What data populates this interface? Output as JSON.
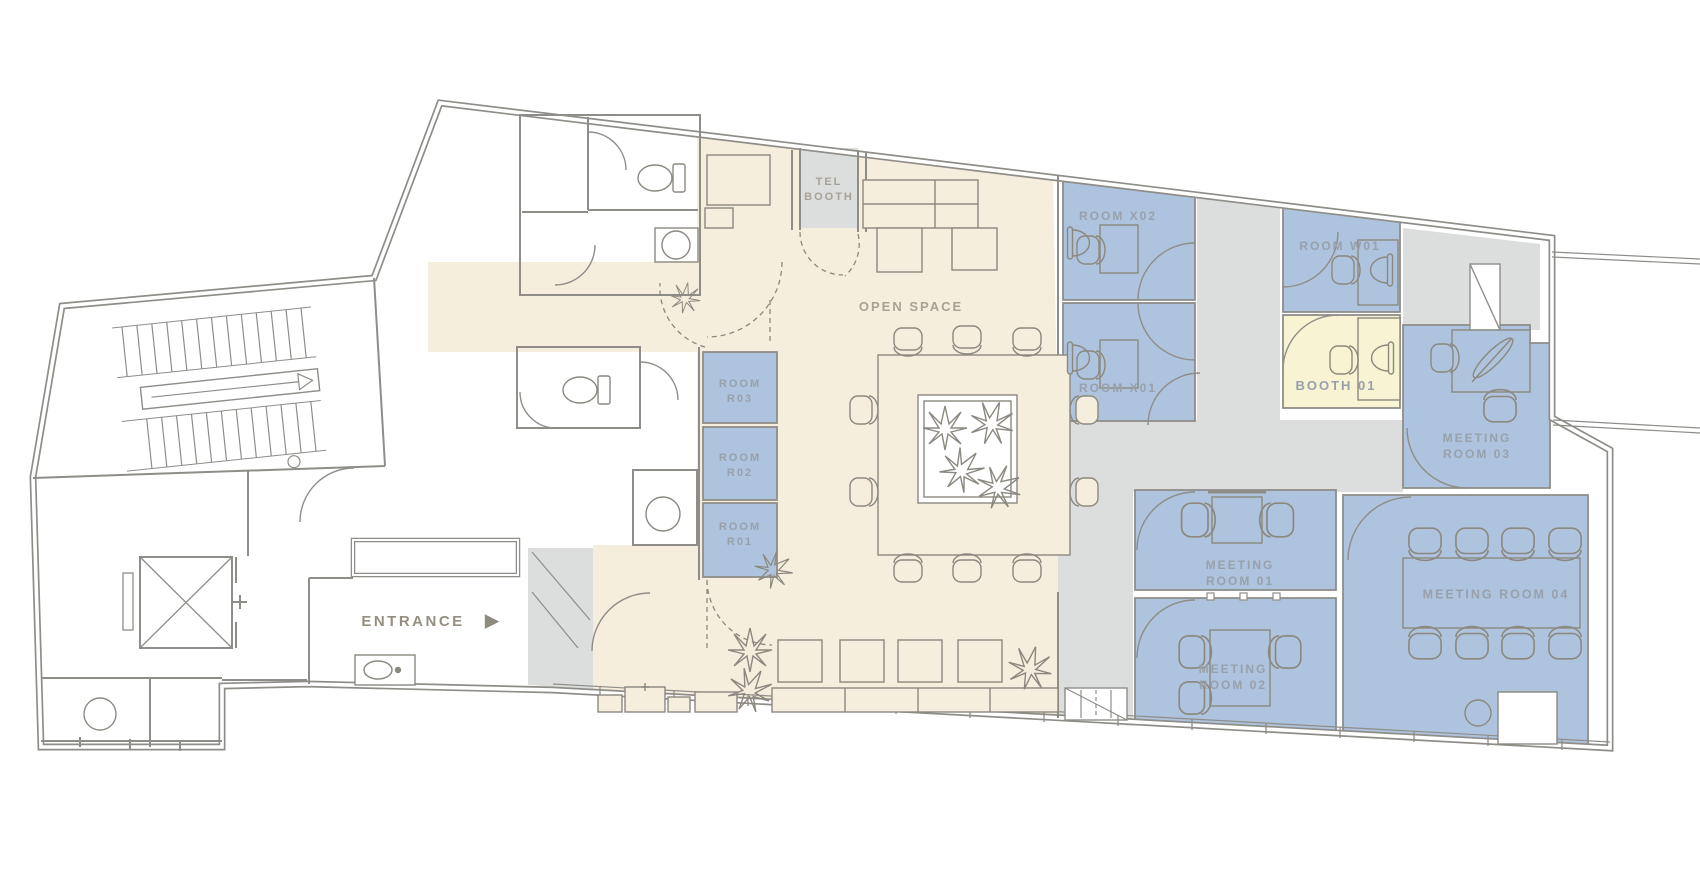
{
  "title": "office-floor-plan",
  "entrance_arrow": "▶",
  "colors": {
    "open_space": "#f6eedd",
    "rooms_blue": "#aec3dd",
    "corridor_gray": "#dcdedd",
    "booth_yellow": "#f7f3d3",
    "walls": "#8f8d88",
    "label_cool": "#98a1ab",
    "label_warm": "#a9a294"
  },
  "labels": [
    {
      "id": "tel-booth",
      "lines": [
        "TEL",
        "BOOTH"
      ],
      "x": 829,
      "y": 190,
      "size": 11,
      "tone": "warm"
    },
    {
      "id": "open-space",
      "lines": [
        "OPEN SPACE"
      ],
      "x": 911,
      "y": 307,
      "size": 13,
      "tone": "warm"
    },
    {
      "id": "room-x02",
      "lines": [
        "ROOM X02"
      ],
      "x": 1118,
      "y": 216,
      "size": 12,
      "tone": "cool"
    },
    {
      "id": "room-x01",
      "lines": [
        "ROOM X01"
      ],
      "x": 1118,
      "y": 388,
      "size": 12,
      "tone": "cool"
    },
    {
      "id": "room-w01",
      "lines": [
        "ROOM W01"
      ],
      "x": 1340,
      "y": 246,
      "size": 12,
      "tone": "cool"
    },
    {
      "id": "booth-01",
      "lines": [
        "BOOTH 01"
      ],
      "x": 1336,
      "y": 386,
      "size": 13,
      "tone": "cool"
    },
    {
      "id": "meeting-room-03",
      "lines": [
        "MEETING",
        "ROOM 03"
      ],
      "x": 1477,
      "y": 446,
      "size": 12,
      "tone": "cool"
    },
    {
      "id": "room-r03",
      "lines": [
        "ROOM",
        "R03"
      ],
      "x": 740,
      "y": 392,
      "size": 11,
      "tone": "cool"
    },
    {
      "id": "room-r02",
      "lines": [
        "ROOM",
        "R02"
      ],
      "x": 740,
      "y": 466,
      "size": 11,
      "tone": "cool"
    },
    {
      "id": "room-r01",
      "lines": [
        "ROOM",
        "R01"
      ],
      "x": 740,
      "y": 535,
      "size": 11,
      "tone": "cool"
    },
    {
      "id": "meeting-room-01",
      "lines": [
        "MEETING",
        "ROOM 01"
      ],
      "x": 1240,
      "y": 573,
      "size": 12,
      "tone": "cool"
    },
    {
      "id": "meeting-room-02",
      "lines": [
        "MEETING",
        "ROOM 02"
      ],
      "x": 1233,
      "y": 677,
      "size": 12,
      "tone": "cool"
    },
    {
      "id": "meeting-room-04",
      "lines": [
        "MEETING ROOM 04"
      ],
      "x": 1496,
      "y": 595,
      "size": 12.5,
      "tone": "cool"
    },
    {
      "id": "entrance",
      "lines": [
        "ENTRANCE"
      ],
      "x": 413,
      "y": 622,
      "size": 15,
      "tone": "dark"
    }
  ]
}
